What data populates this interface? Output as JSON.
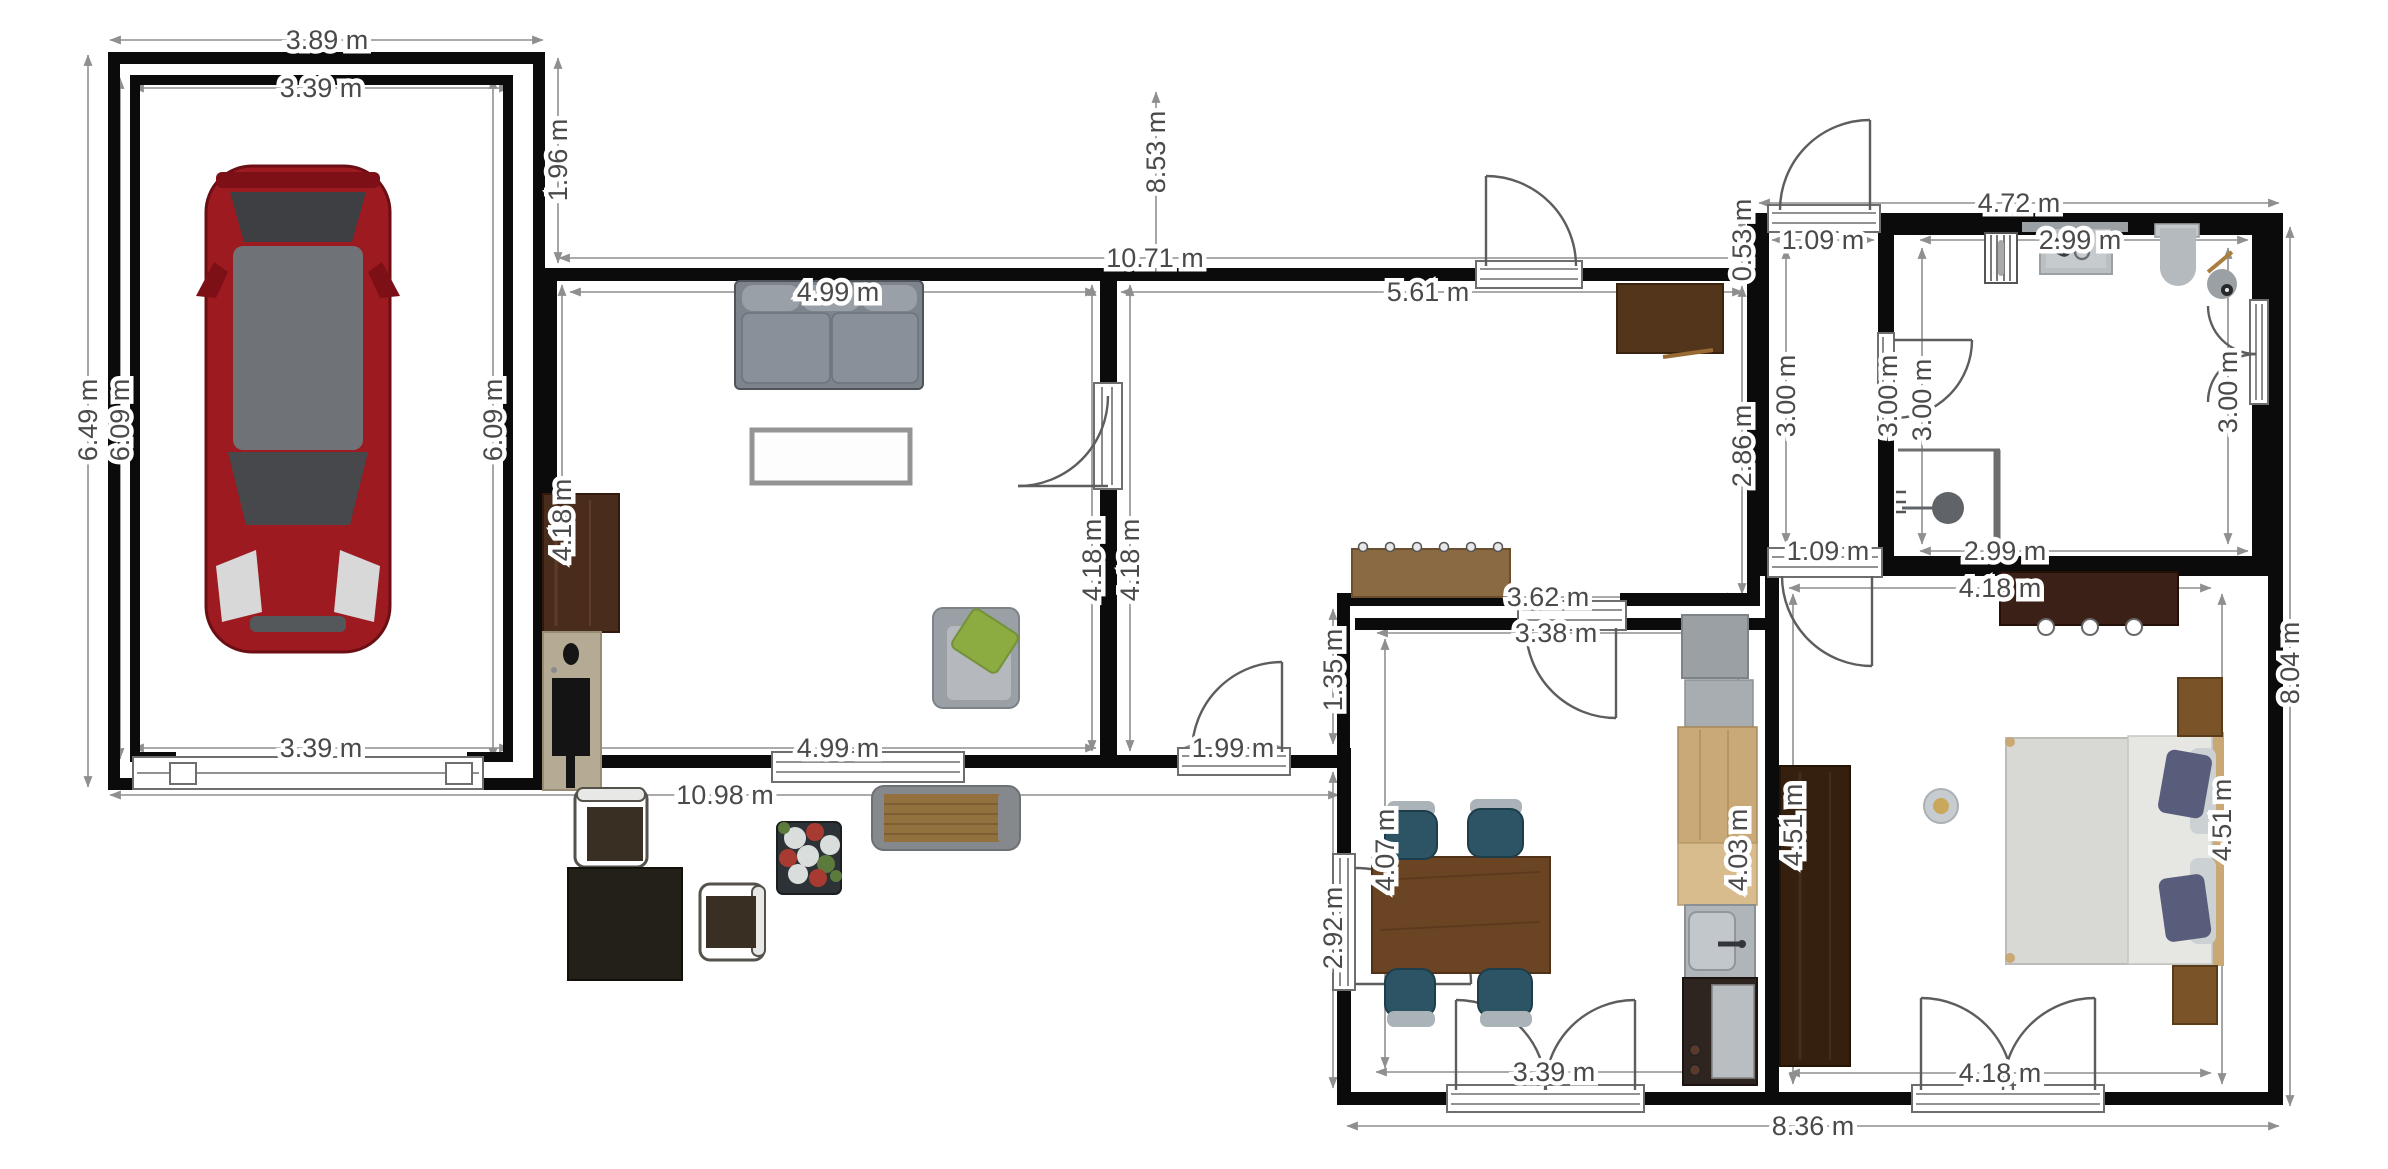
{
  "plan": {
    "type": "floor-plan",
    "units": "m",
    "rooms": [
      "garage",
      "living-room",
      "hall",
      "entry-corridor",
      "bathroom",
      "kitchen-dining",
      "bedroom",
      "terrace"
    ]
  },
  "dims": {
    "garage_width_outer": "3.89 m",
    "garage_width_inner": "3.39 m",
    "garage_height_outer": "6.49 m",
    "garage_height_inner_left": "6.09 m",
    "garage_height_inner_right": "6.09 m",
    "garage_width_inner_bottom": "3.39 m",
    "passage_height": "1.96 m",
    "north_offset": "8.53 m",
    "main_block_width": "10.71 m",
    "living_width_top": "4.99 m",
    "hall_width_top": "5.61 m",
    "living_height_left": "4.18 m",
    "living_height_right": "4.18 m",
    "hall_height_left": "4.18 m",
    "living_width_bottom": "4.99 m",
    "back_door_width": "1.99 m",
    "south_facade_width": "10.98 m",
    "annex_wall_upper": "1.35 m",
    "annex_wall_lower": "2.92 m",
    "hall_width_bottom": "3.62 m",
    "hall_height_right": "2.86 m",
    "block_offset": "0.53 m",
    "bath_block_width": "4.72 m",
    "entry_width_top": "1.09 m",
    "entry_height_left": "3.00 m",
    "entry_height_right": "3.00 m",
    "bath_height_left": "3.00 m",
    "bath_width_top": "2.99 m",
    "bath_height_right": "3.00 m",
    "entry_width_bottom": "1.09 m",
    "bath_width_bottom": "2.99 m",
    "kitchen_width_top": "3.38 m",
    "kitchen_height_left": "4.07 m",
    "kitchen_height_right": "4.03 m",
    "kitchen_width_bottom": "3.39 m",
    "bedroom_width_top": "4.18 m",
    "bedroom_height_left": "4.51 m",
    "bedroom_height_right": "4.51 m",
    "bedroom_width_bottom": "4.18 m",
    "east_facade_height": "8.04 m",
    "south_annex_width": "8.36 m"
  },
  "colors": {
    "wall": "#0b0b0b",
    "dimension_line": "#8f8f8f",
    "dimension_text": "#4a4a4a",
    "car_body": "#9c1a20",
    "sofa_gray": "#8a9099",
    "armchair_cushion_green": "#8cab40",
    "dining_chair_teal": "#2c5464",
    "table_wood": "#6b4423",
    "dark_wood": "#3a2016",
    "light_wood_cabinet": "#c8a977",
    "bench_wood": "#93713f",
    "appliance_gray": "#aab0b4"
  }
}
